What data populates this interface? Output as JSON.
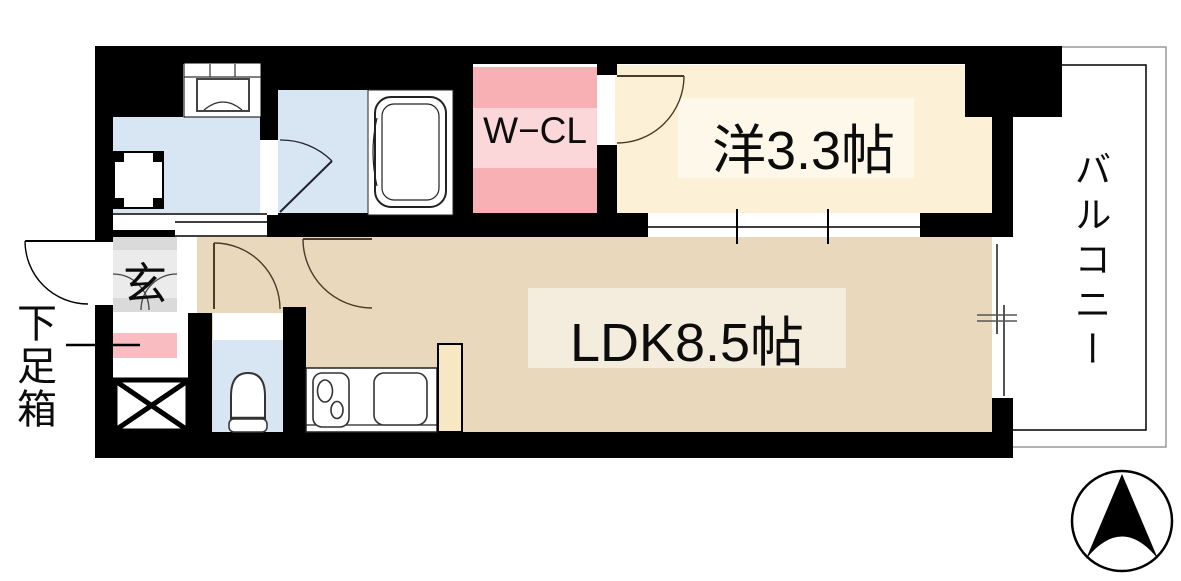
{
  "floorplan": {
    "labels": {
      "walk_in_closet": "W−CL",
      "western_room": "洋3.3帖",
      "ldk": "LDK8.5帖",
      "balcony": "バルコニー",
      "entrance": "玄",
      "shoe_box": "下足箱"
    },
    "colors": {
      "wall": "#000000",
      "wet_room_blue": "#D8E6F4",
      "western_room_cream": "#FCF1D7",
      "western_room_label_band": "#FDF8EA",
      "ldk_tan": "#E9D8BC",
      "ldk_label_band": "#F4ECDD",
      "closet_pink": "#F8B0B5",
      "closet_label_band": "#FBD7DA",
      "shoe_box_pink": "#F9BCC1",
      "entrance_gray": "#DADADA",
      "entrance_label_band": "#EBEBEB",
      "kitchen_partition": "#F8E7C3",
      "balcony_inner_line": "#000000",
      "balcony_outer_line": "#999999"
    },
    "icons": {
      "compass": "north-arrow"
    }
  }
}
